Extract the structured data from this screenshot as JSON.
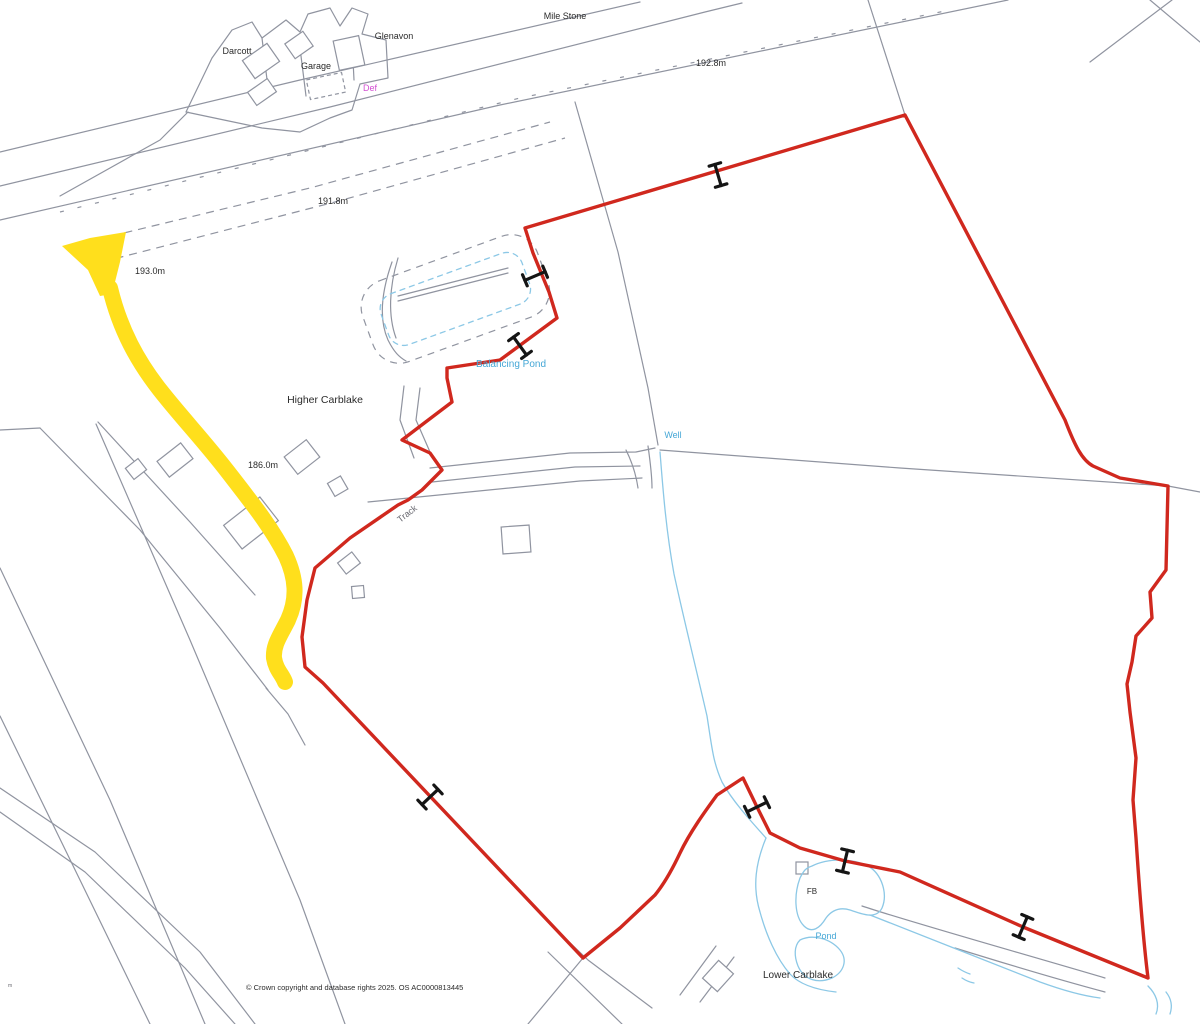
{
  "map": {
    "title": "Site location plan - Carblake",
    "background": "#ffffff",
    "colors": {
      "boundary_red": "#d0281e",
      "highlight_yellow": "#ffdf1c",
      "linework_gray": "#9094a0",
      "water_blue": "#8cc8e6",
      "water_text": "#45a7d6",
      "magenta": "#d24fd2",
      "black": "#2b2b2b",
      "gray_text": "#6a6a72",
      "marker_black": "#151515"
    },
    "labels": [
      {
        "name": "label-darcott",
        "text": "Darcott",
        "x": 237,
        "y": 54,
        "size": 9,
        "color": "black"
      },
      {
        "name": "label-glenavon",
        "text": "Glenavon",
        "x": 394,
        "y": 39,
        "size": 9,
        "color": "black"
      },
      {
        "name": "label-garage",
        "text": "Garage",
        "x": 316,
        "y": 69,
        "size": 9,
        "color": "black"
      },
      {
        "name": "label-def",
        "text": "Def",
        "x": 370,
        "y": 91,
        "size": 9,
        "color": "magenta"
      },
      {
        "name": "label-mile-stone",
        "text": "Mile Stone",
        "x": 565,
        "y": 19,
        "size": 9,
        "color": "black"
      },
      {
        "name": "label-spot-192-8",
        "text": "192.8m",
        "x": 711,
        "y": 66,
        "size": 9,
        "color": "black"
      },
      {
        "name": "label-spot-191-8",
        "text": "191.8m",
        "x": 333,
        "y": 204,
        "size": 9,
        "color": "black"
      },
      {
        "name": "label-spot-193-0",
        "text": "193.0m",
        "x": 150,
        "y": 274,
        "size": 9,
        "color": "black"
      },
      {
        "name": "label-higher-carblake",
        "text": "Higher Carblake",
        "x": 325,
        "y": 403,
        "size": 10.5,
        "color": "black"
      },
      {
        "name": "label-spot-186-0",
        "text": "186.0m",
        "x": 263,
        "y": 468,
        "size": 9,
        "color": "black"
      },
      {
        "name": "label-balancing-pond",
        "text": "Balancing Pond",
        "x": 511,
        "y": 367,
        "size": 10,
        "color": "water_text"
      },
      {
        "name": "label-well",
        "text": "Well",
        "x": 673,
        "y": 438,
        "size": 9,
        "color": "water_text"
      },
      {
        "name": "label-track",
        "text": "Track",
        "x": 409,
        "y": 516,
        "size": 9,
        "color": "gray_text",
        "rot": -38
      },
      {
        "name": "label-fb",
        "text": "FB",
        "x": 812,
        "y": 894,
        "size": 8,
        "color": "black"
      },
      {
        "name": "label-pond",
        "text": "Pond",
        "x": 826,
        "y": 939,
        "size": 9,
        "color": "water_text"
      },
      {
        "name": "label-lower-carblake",
        "text": "Lower Carblake",
        "x": 798,
        "y": 978,
        "size": 10,
        "color": "black"
      },
      {
        "name": "label-scale-mark",
        "text": "m",
        "x": 8,
        "y": 987,
        "size": 5,
        "color": "gray_text",
        "anchor": "start"
      },
      {
        "name": "copyright-text",
        "text": "© Crown copyright and database rights 2025. OS AC0000813445",
        "x": 246,
        "y": 990,
        "size": 7.5,
        "color": "black",
        "anchor": "start"
      }
    ],
    "access_markers": [
      {
        "x": 718,
        "y": 175,
        "angle": -16.5
      },
      {
        "x": 535,
        "y": 276,
        "angle": 67
      },
      {
        "x": 520,
        "y": 346,
        "angle": 144
      },
      {
        "x": 430,
        "y": 797,
        "angle": 46.6
      },
      {
        "x": 757,
        "y": 807,
        "angle": 64
      },
      {
        "x": 845,
        "y": 861,
        "angle": 13.5
      },
      {
        "x": 1023,
        "y": 927,
        "angle": 23
      }
    ]
  }
}
